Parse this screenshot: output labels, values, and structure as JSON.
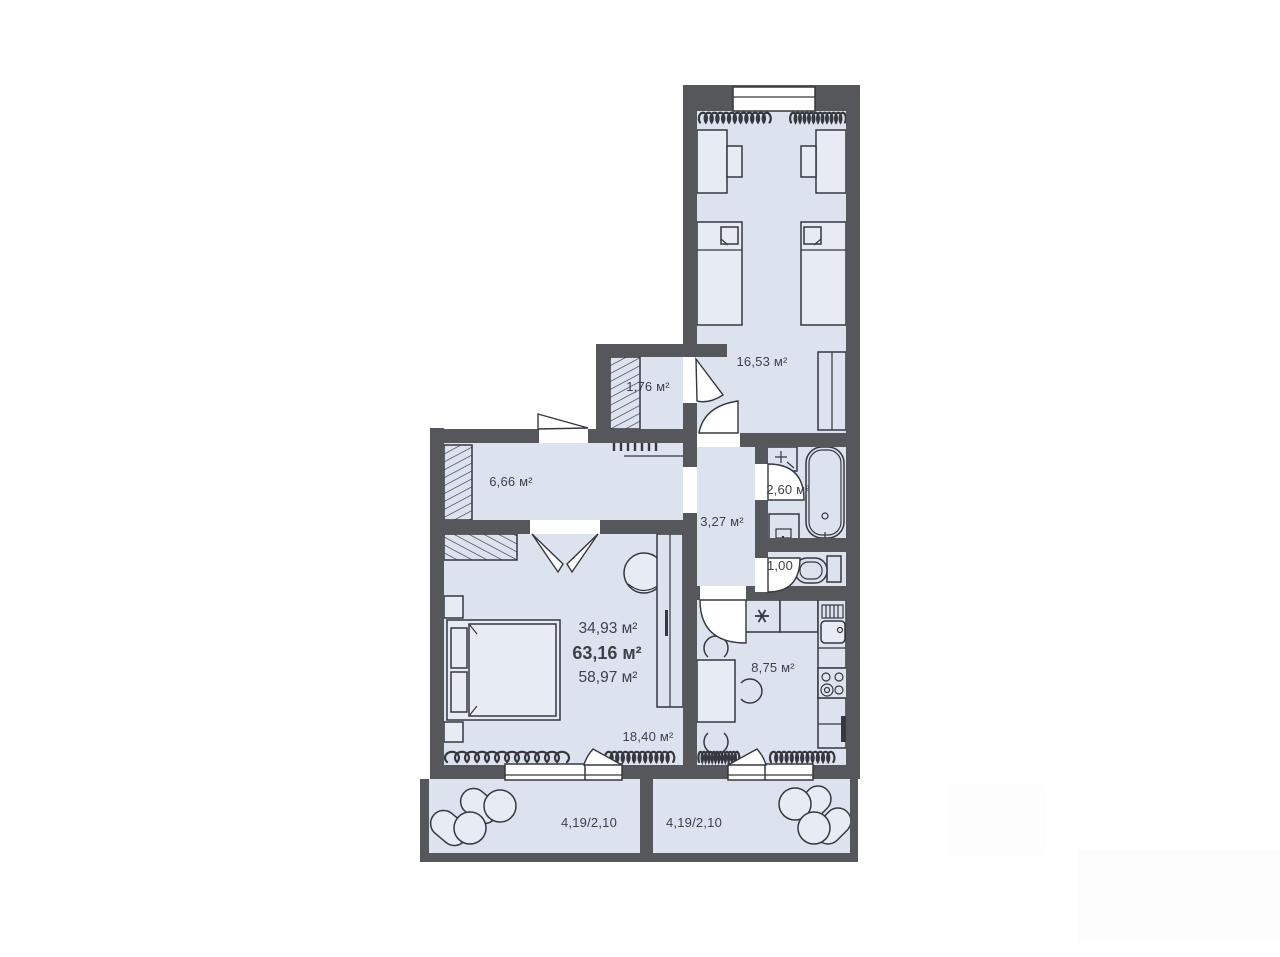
{
  "colors": {
    "wall": "#55575b",
    "floor": "#dce3ee",
    "furniture": "#e6ebf4",
    "line": "#35383e",
    "text": "#3e4147",
    "background": "#ffffff"
  },
  "rooms": {
    "bedroom": {
      "area_label": "16,53 м²"
    },
    "closet": {
      "area_label": "1,76 м²"
    },
    "hallway": {
      "area_label": "6,66 м²"
    },
    "bathroom": {
      "area_label": "2,60 м²"
    },
    "corridor": {
      "area_label": "3,27 м²"
    },
    "wc": {
      "area_label": "1,00"
    },
    "kitchen": {
      "area_label": "8,75 м²"
    },
    "living_room": {
      "area_label": "18,40 м²"
    }
  },
  "totals": {
    "living_area": "34,93 м²",
    "total_area": "63,16 м²",
    "reduced_area": "58,97 м²"
  },
  "balconies": {
    "left": {
      "size_label": "4,19/2,10"
    },
    "right": {
      "size_label": "4,19/2,10"
    }
  }
}
